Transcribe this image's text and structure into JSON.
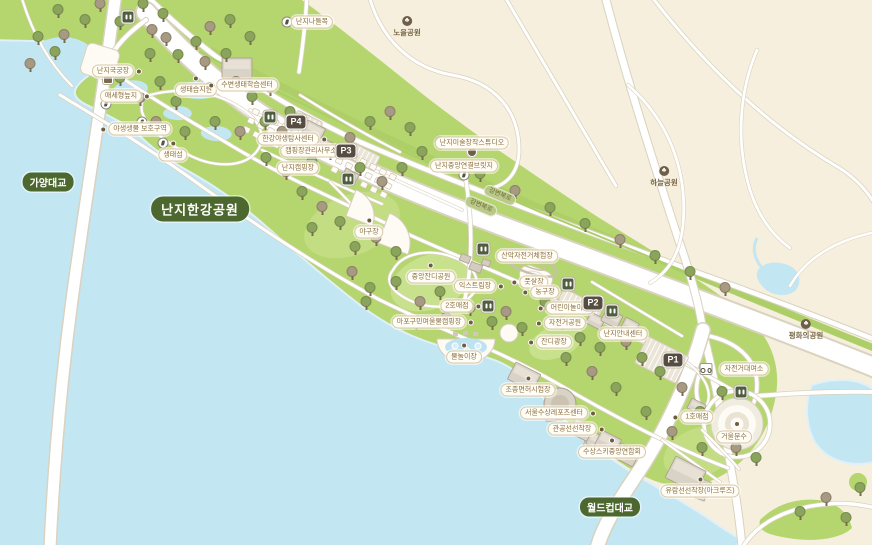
{
  "map": {
    "badges": {
      "title": "난지한강공원",
      "gayang": "가양대교",
      "worldcup": "월드컵대교"
    },
    "road_labels": [
      {
        "label": "강변북로",
        "x": 481,
        "y": 206
      },
      {
        "label": "강변북로",
        "x": 500,
        "y": 195
      }
    ],
    "parks": [
      {
        "id": "noeul-park",
        "label": "노을공원",
        "x": 407,
        "y": 27
      },
      {
        "id": "haneul-park",
        "label": "하늘공원",
        "x": 664,
        "y": 177
      },
      {
        "id": "pyeonghwa-park",
        "label": "평화의공원",
        "x": 806,
        "y": 330
      }
    ],
    "parking": [
      {
        "label": "P1",
        "x": 673,
        "y": 360
      },
      {
        "label": "P2",
        "x": 593,
        "y": 303
      },
      {
        "label": "P3",
        "x": 346,
        "y": 151
      },
      {
        "label": "P4",
        "x": 296,
        "y": 122
      }
    ],
    "places": [
      {
        "id": "nanji-archery",
        "label": "난지국궁장",
        "x": 113,
        "y": 71,
        "dot": "right"
      },
      {
        "id": "maeseohyeong-wetland",
        "label": "매세형늪지",
        "x": 121,
        "y": 96,
        "dot": "right"
      },
      {
        "id": "wildlife-protection-area",
        "label": "야생생물 보호구역",
        "x": 140,
        "y": 129,
        "dot": "left"
      },
      {
        "id": "ecology-island",
        "label": "생태섬",
        "x": 173,
        "y": 155,
        "dot": "top"
      },
      {
        "id": "ecology-wetland-garden",
        "label": "생태습지원",
        "x": 196,
        "y": 90,
        "dot": "top"
      },
      {
        "id": "waterside-ecology-center",
        "label": "수변생태학습센터",
        "x": 247,
        "y": 85,
        "dot": "left"
      },
      {
        "id": "nanji-underpass",
        "label": "난지나들목",
        "x": 312,
        "y": 22
      },
      {
        "id": "hangang-wildlife-center",
        "label": "한강야생탐사센터",
        "x": 288,
        "y": 139,
        "dot": "right"
      },
      {
        "id": "campground-office",
        "label": "캠핑장관리사무소",
        "x": 311,
        "y": 151,
        "dot": "right"
      },
      {
        "id": "nanji-campground",
        "label": "난지캠핑장",
        "x": 298,
        "y": 168
      },
      {
        "id": "nanji-art-studio",
        "label": "난지미술창작스튜디오",
        "x": 472,
        "y": 143
      },
      {
        "id": "nanji-central-bridge",
        "label": "난지중앙연결브릿지",
        "x": 464,
        "y": 166
      },
      {
        "id": "baseball-field",
        "label": "야구장",
        "x": 369,
        "y": 232,
        "dot": "top"
      },
      {
        "id": "central-lawn-park",
        "label": "중앙잔디공원",
        "x": 431,
        "y": 277,
        "dot": "top"
      },
      {
        "id": "mtb-course",
        "label": "산악자전거체험장",
        "x": 527,
        "y": 256
      },
      {
        "id": "futsal-court",
        "label": "풋살장",
        "x": 534,
        "y": 282,
        "dot": "left"
      },
      {
        "id": "basketball-court",
        "label": "농구장",
        "x": 545,
        "y": 292,
        "dot": "left"
      },
      {
        "id": "extreme-sports-area",
        "label": "익스트림장",
        "x": 475,
        "y": 286,
        "dot": "right"
      },
      {
        "id": "store-2",
        "label": "2호매점",
        "x": 457,
        "y": 306,
        "dot": "right"
      },
      {
        "id": "children-playground",
        "label": "어린이놀이터",
        "x": 570,
        "y": 308,
        "dot": "left"
      },
      {
        "id": "bicycle-park",
        "label": "자전거공원",
        "x": 565,
        "y": 323,
        "dot": "left"
      },
      {
        "id": "lawn-plaza",
        "label": "잔디광장",
        "x": 554,
        "y": 342,
        "dot": "left"
      },
      {
        "id": "mapo-riverside-campground",
        "label": "마포구민여울물캠핑장",
        "x": 429,
        "y": 322,
        "dot": "right"
      },
      {
        "id": "swimming-pool",
        "label": "물놀이장",
        "x": 464,
        "y": 357,
        "dot": "top"
      },
      {
        "id": "nanji-info-center",
        "label": "난지안내센터",
        "x": 623,
        "y": 334
      },
      {
        "id": "bike-rental",
        "label": "자전거대여소",
        "x": 744,
        "y": 369
      },
      {
        "id": "boat-license-test-center",
        "label": "조종면허시험장",
        "x": 528,
        "y": 390,
        "dot": "top"
      },
      {
        "id": "seoul-water-sports-center",
        "label": "서울수상레포츠센터",
        "x": 554,
        "y": 413,
        "dot": "right"
      },
      {
        "id": "public-vessel-dock",
        "label": "관공선선착장",
        "x": 572,
        "y": 429,
        "dot": "right"
      },
      {
        "id": "water-ski-association",
        "label": "수상스키중앙연합회",
        "x": 612,
        "y": 452,
        "dot": "top"
      },
      {
        "id": "store-1",
        "label": "1호매점",
        "x": 697,
        "y": 417,
        "dot": "left"
      },
      {
        "id": "mirror-fountain",
        "label": "거울분수",
        "x": 734,
        "y": 437
      },
      {
        "id": "cruise-dock",
        "label": "유람선선착장(아크루즈)",
        "x": 700,
        "y": 491,
        "dot": "top"
      }
    ],
    "icons": {
      "restrooms": [
        [
          128,
          17
        ],
        [
          270,
          117
        ],
        [
          348,
          179
        ],
        [
          483,
          249
        ],
        [
          488,
          306
        ],
        [
          568,
          284
        ],
        [
          612,
          311
        ],
        [
          741,
          392
        ]
      ],
      "pedestrians": [
        [
          106,
          104
        ],
        [
          142,
          122
        ],
        [
          163,
          143
        ],
        [
          287,
          22
        ],
        [
          464,
          175
        ]
      ],
      "bike_rental": [
        706,
        369
      ],
      "trail_sign": [
        108,
        79
      ],
      "art_studio_marker": [
        472,
        152
      ]
    },
    "colors": {
      "water": "#c3e6f3",
      "land": "#f6efdd",
      "park_green": "#b5d56e",
      "badge_green": "#4c682e",
      "parking_badge": "#564c40",
      "label_text": "#8a7044"
    },
    "decor": {
      "trees": [
        [
          38,
          45,
          0
        ],
        [
          58,
          18,
          0
        ],
        [
          64,
          43,
          1
        ],
        [
          85,
          28,
          0
        ],
        [
          100,
          12,
          1
        ],
        [
          120,
          30,
          0
        ],
        [
          143,
          12,
          0
        ],
        [
          152,
          38,
          1
        ],
        [
          163,
          22,
          0
        ],
        [
          30,
          72,
          1
        ],
        [
          55,
          60,
          0
        ],
        [
          150,
          62,
          0
        ],
        [
          166,
          46,
          1
        ],
        [
          178,
          63,
          0
        ],
        [
          196,
          50,
          0
        ],
        [
          210,
          35,
          1
        ],
        [
          230,
          28,
          0
        ],
        [
          250,
          45,
          0
        ],
        [
          205,
          70,
          1
        ],
        [
          226,
          62,
          0
        ],
        [
          160,
          90,
          0
        ],
        [
          140,
          106,
          1
        ],
        [
          176,
          110,
          0
        ],
        [
          210,
          96,
          0
        ],
        [
          236,
          90,
          1
        ],
        [
          252,
          105,
          0
        ],
        [
          270,
          96,
          0
        ],
        [
          156,
          130,
          1
        ],
        [
          185,
          140,
          0
        ],
        [
          215,
          130,
          0
        ],
        [
          240,
          140,
          1
        ],
        [
          265,
          130,
          0
        ],
        [
          120,
          86,
          0
        ],
        [
          290,
          120,
          0
        ],
        [
          282,
          140,
          1
        ],
        [
          300,
          156,
          0
        ],
        [
          266,
          166,
          0
        ],
        [
          286,
          180,
          1
        ],
        [
          312,
          170,
          0
        ],
        [
          330,
          160,
          0
        ],
        [
          350,
          146,
          1
        ],
        [
          370,
          130,
          0
        ],
        [
          390,
          120,
          1
        ],
        [
          410,
          136,
          0
        ],
        [
          360,
          176,
          0
        ],
        [
          382,
          190,
          1
        ],
        [
          402,
          176,
          0
        ],
        [
          422,
          160,
          0
        ],
        [
          440,
          150,
          1
        ],
        [
          302,
          200,
          0
        ],
        [
          322,
          215,
          1
        ],
        [
          340,
          230,
          0
        ],
        [
          312,
          236,
          0
        ],
        [
          355,
          255,
          0
        ],
        [
          376,
          246,
          1
        ],
        [
          396,
          260,
          0
        ],
        [
          352,
          280,
          1
        ],
        [
          370,
          296,
          0
        ],
        [
          396,
          290,
          0
        ],
        [
          420,
          310,
          1
        ],
        [
          440,
          300,
          0
        ],
        [
          416,
          330,
          0
        ],
        [
          446,
          326,
          1
        ],
        [
          470,
          316,
          0
        ],
        [
          492,
          330,
          0
        ],
        [
          506,
          320,
          1
        ],
        [
          522,
          336,
          0
        ],
        [
          366,
          310,
          0
        ],
        [
          545,
          310,
          0
        ],
        [
          562,
          330,
          1
        ],
        [
          580,
          346,
          0
        ],
        [
          600,
          356,
          0
        ],
        [
          626,
          350,
          1
        ],
        [
          642,
          366,
          0
        ],
        [
          660,
          380,
          0
        ],
        [
          682,
          396,
          1
        ],
        [
          700,
          420,
          0
        ],
        [
          722,
          400,
          0
        ],
        [
          736,
          456,
          1
        ],
        [
          756,
          466,
          0
        ],
        [
          702,
          456,
          0
        ],
        [
          672,
          440,
          1
        ],
        [
          646,
          420,
          0
        ],
        [
          616,
          396,
          0
        ],
        [
          592,
          380,
          1
        ],
        [
          566,
          366,
          0
        ],
        [
          480,
          182,
          0
        ],
        [
          515,
          199,
          1
        ],
        [
          550,
          216,
          0
        ],
        [
          585,
          232,
          0
        ],
        [
          620,
          248,
          1
        ],
        [
          655,
          264,
          0
        ],
        [
          690,
          280,
          0
        ],
        [
          725,
          296,
          1
        ],
        [
          800,
          520,
          0
        ],
        [
          826,
          506,
          1
        ],
        [
          846,
          526,
          0
        ],
        [
          860,
          496,
          0
        ]
      ]
    }
  }
}
